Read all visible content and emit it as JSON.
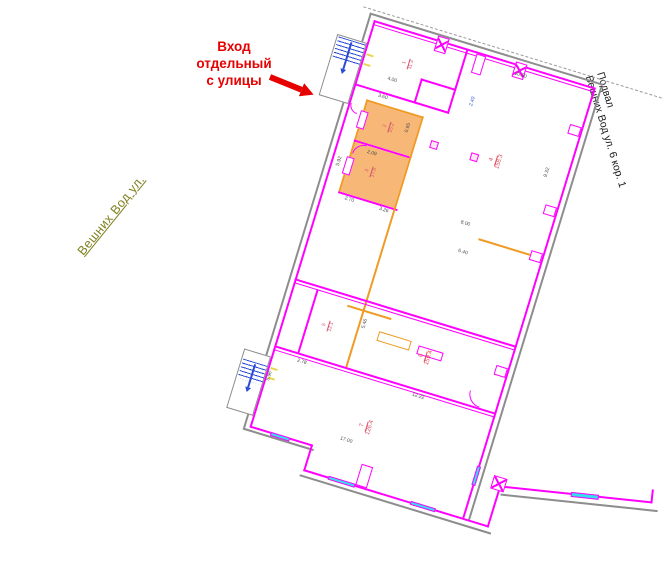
{
  "annotations": {
    "entrance_note": {
      "lines": [
        "Вход",
        "отдельный",
        "с улицы"
      ],
      "color": "#e60000"
    },
    "street_label": {
      "text": "Вешних Вод ул.",
      "color": "#7f7f1e"
    },
    "building_label": {
      "lines": [
        "Подвал",
        "Вешних Вод ул. 6 кор. 1"
      ],
      "color": "#1a1a1a"
    }
  },
  "plan": {
    "rotation_deg": 17,
    "colors": {
      "wall": "#ff00ff",
      "orange": "#ef9b26",
      "room_fill": "#f6b26b",
      "gray": "#8d8d8d",
      "dash": "#9a9a9a",
      "window": "#35e0ee",
      "stair": "#2a4bd7",
      "tick": "#e5d84b",
      "dim_text": "#4a4a4a",
      "elev": "#3b5bd0",
      "room_label": "#d4526e",
      "room_label_big": "#e04a5a",
      "column_fill": "#fde8f5"
    },
    "walls": [
      {
        "x": -14,
        "y": -10,
        "w": 312,
        "h": 0,
        "c": "dash"
      },
      {
        "x": -6,
        "y": -6,
        "w": 2,
        "h": 434,
        "c": "gray"
      },
      {
        "x": -6,
        "y": -6,
        "w": 244,
        "h": 2,
        "c": "gray"
      },
      {
        "x": 236,
        "y": -2,
        "w": 2,
        "h": 452,
        "c": "gray"
      },
      {
        "x": -6,
        "y": 428,
        "w": 74,
        "h": 2,
        "c": "gray"
      },
      {
        "x": 62,
        "y": 456,
        "w": 200,
        "h": 2,
        "c": "gray"
      },
      {
        "x": 0,
        "y": 0,
        "w": 232,
        "h": 2,
        "c": "wall"
      },
      {
        "x": 0,
        "y": 4,
        "w": 232,
        "h": 1,
        "c": "wall"
      },
      {
        "x": 0,
        "y": 0,
        "w": 2,
        "h": 426,
        "c": "wall"
      },
      {
        "x": 230,
        "y": 0,
        "w": 2,
        "h": 450,
        "c": "wall"
      },
      {
        "x": 0,
        "y": 424,
        "w": 66,
        "h": 2,
        "c": "wall"
      },
      {
        "x": 64,
        "y": 424,
        "w": 2,
        "h": 28,
        "c": "wall"
      },
      {
        "x": 64,
        "y": 450,
        "w": 194,
        "h": 2,
        "c": "wall"
      },
      {
        "x": 256,
        "y": 408,
        "w": 2,
        "h": 44,
        "c": "wall"
      },
      {
        "x": 97,
        "y": 0,
        "w": 2,
        "h": 68,
        "c": "wall"
      },
      {
        "x": 0,
        "y": 66,
        "w": 99,
        "h": 2,
        "c": "wall"
      },
      {
        "x": 62,
        "y": 42,
        "w": 37,
        "h": 1.5,
        "c": "wall"
      },
      {
        "x": 62,
        "y": 42,
        "w": 1.5,
        "h": 26,
        "c": "wall"
      },
      {
        "x": 16,
        "y": 78,
        "w": 60,
        "h": 1.5,
        "c": "orange"
      },
      {
        "x": 16,
        "y": 78,
        "w": 1.5,
        "h": 96,
        "c": "orange"
      },
      {
        "x": 16,
        "y": 120,
        "w": 60,
        "h": 1.5,
        "c": "wall"
      },
      {
        "x": 16,
        "y": 174,
        "w": 62,
        "h": 1.5,
        "c": "wall"
      },
      {
        "x": 74,
        "y": 78,
        "w": 1.5,
        "h": 262,
        "c": "orange"
      },
      {
        "x": 0,
        "y": 270,
        "w": 232,
        "h": 2,
        "c": "wall"
      },
      {
        "x": 0,
        "y": 274,
        "w": 232,
        "h": 1,
        "c": "wall"
      },
      {
        "x": 0,
        "y": 340,
        "w": 232,
        "h": 2,
        "c": "wall"
      },
      {
        "x": 0,
        "y": 344,
        "w": 232,
        "h": 1,
        "c": "wall"
      },
      {
        "x": 24,
        "y": 274,
        "w": 1.5,
        "h": 66,
        "c": "wall"
      },
      {
        "x": 58,
        "y": 280,
        "w": 46,
        "h": 2,
        "c": "orange"
      },
      {
        "x": 164,
        "y": 178,
        "w": 66,
        "h": 1.5,
        "c": "orange"
      },
      {
        "x": 138,
        "y": 298,
        "w": 26,
        "h": 9,
        "c": "wallbox"
      },
      {
        "x": 96,
        "y": 296,
        "w": 34,
        "h": 10,
        "c": "orangebox"
      },
      {
        "x": 118,
        "y": 428,
        "w": 12,
        "h": 22,
        "c": "wallbox"
      }
    ],
    "wing": {
      "x": 258,
      "y": 408,
      "rot": -11,
      "parts": [
        {
          "x": 0,
          "y": 0,
          "w": 152,
          "h": 2,
          "c": "wall"
        },
        {
          "x": 0,
          "y": 8,
          "w": 158,
          "h": 2,
          "c": "gray"
        },
        {
          "x": 150,
          "y": -12,
          "w": 2,
          "h": 14,
          "c": "wall"
        }
      ],
      "window": {
        "x": 70,
        "y": -1,
        "w": 28,
        "h": 5
      }
    },
    "fills": [
      {
        "x": 18,
        "y": 80,
        "w": 56,
        "h": 40
      },
      {
        "x": 18,
        "y": 122,
        "w": 56,
        "h": 52
      }
    ],
    "windows": [
      {
        "x": 15,
        "y": 92,
        "w": 4,
        "h": 14
      },
      {
        "x": 15,
        "y": 140,
        "w": 4,
        "h": 14
      },
      {
        "x": 22,
        "y": 424,
        "w": 20,
        "h": 4
      },
      {
        "x": 90,
        "y": 449,
        "w": 28,
        "h": 4
      },
      {
        "x": 176,
        "y": 449,
        "w": 26,
        "h": 4
      },
      {
        "x": 229,
        "y": 396,
        "w": 4,
        "h": 20
      }
    ],
    "columns": [
      {
        "t": "x",
        "x": 66,
        "y": -4,
        "w": 12,
        "h": 16
      },
      {
        "t": "x",
        "x": 148,
        "y": -2,
        "w": 12,
        "h": 16
      },
      {
        "t": "x",
        "x": 248,
        "y": 400,
        "w": 14,
        "h": 14
      },
      {
        "t": "pil",
        "x": 108,
        "y": 2,
        "w": 10,
        "h": 20
      },
      {
        "t": "pil",
        "x": 218,
        "y": 42,
        "w": 12,
        "h": 10
      },
      {
        "t": "pil",
        "x": 218,
        "y": 126,
        "w": 12,
        "h": 10
      },
      {
        "t": "pil",
        "x": 218,
        "y": 174,
        "w": 12,
        "h": 10
      },
      {
        "t": "pil",
        "x": 218,
        "y": 294,
        "w": 12,
        "h": 10
      },
      {
        "t": "pil",
        "x": 14,
        "y": 90,
        "w": 8,
        "h": 18
      },
      {
        "t": "pil",
        "x": 14,
        "y": 138,
        "w": 8,
        "h": 18
      },
      {
        "t": "sq",
        "x": 90,
        "y": 98,
        "w": 8,
        "h": 8
      },
      {
        "t": "sq",
        "x": 132,
        "y": 98,
        "w": 8,
        "h": 8
      }
    ],
    "stairs": [
      {
        "x": -31,
        "y": 24,
        "w": 31,
        "h": 64,
        "tx": -29,
        "ty": 26,
        "tw": 28,
        "th": 22,
        "ax": -16,
        "ay": 28,
        "al": 28
      },
      {
        "x": -28,
        "y": 352,
        "w": 28,
        "h": 62,
        "tx": -26,
        "ty": 362,
        "tw": 25,
        "th": 20,
        "ax": -14,
        "ay": 364,
        "al": 24
      }
    ],
    "arcs": [
      {
        "x": 18,
        "y": 122,
        "r": 12,
        "q": "tl"
      },
      {
        "x": 200,
        "y": 326,
        "r": 14,
        "q": "bl"
      },
      {
        "x": 2,
        "y": 86,
        "r": 9,
        "q": "bl"
      }
    ],
    "ticks": [
      {
        "x": 3,
        "y": 34
      },
      {
        "x": 3,
        "y": 44
      },
      {
        "x": 3,
        "y": 362
      },
      {
        "x": 3,
        "y": 372
      }
    ],
    "dimensions": [
      {
        "t": "4.00",
        "x": 30,
        "y": 50,
        "r": 0
      },
      {
        "t": "3.60",
        "x": 26,
        "y": 69,
        "r": 0
      },
      {
        "t": "0.65",
        "x": 62,
        "y": 98,
        "r": 90
      },
      {
        "t": "2.09",
        "x": 32,
        "y": 126,
        "r": 0
      },
      {
        "t": "5.92",
        "x": 6,
        "y": 150,
        "r": 90
      },
      {
        "t": "10.50",
        "x": 150,
        "y": 8,
        "r": 0
      },
      {
        "t": "9.32",
        "x": 208,
        "y": 100,
        "r": 90
      },
      {
        "t": "2.40",
        "x": 116,
        "y": 54,
        "r": 90,
        "c": "elev"
      },
      {
        "t": "2.70",
        "x": 24,
        "y": 177,
        "r": 0
      },
      {
        "t": "3.26",
        "x": 60,
        "y": 177,
        "r": 0
      },
      {
        "t": "8.00",
        "x": 142,
        "y": 166,
        "r": 0
      },
      {
        "t": "6.40",
        "x": 148,
        "y": 194,
        "r": 0
      },
      {
        "t": "5.46",
        "x": 78,
        "y": 298,
        "r": 90
      },
      {
        "t": "2.78",
        "x": 26,
        "y": 346,
        "r": 0
      },
      {
        "t": "12.22",
        "x": 146,
        "y": 345,
        "r": 0
      },
      {
        "t": "17.00",
        "x": 90,
        "y": 408,
        "r": 0
      },
      {
        "t": "5.96",
        "x": 2,
        "y": 376,
        "r": 90
      }
    ],
    "room_labels": [
      {
        "num": "1",
        "area": "11.3",
        "x": 40,
        "y": 26,
        "big": false
      },
      {
        "num": "2",
        "area": "15.2",
        "x": 40,
        "y": 92,
        "big": false
      },
      {
        "num": "3",
        "area": "17.6",
        "x": 36,
        "y": 140,
        "big": false
      },
      {
        "num": "4",
        "area": "158.3",
        "x": 150,
        "y": 92,
        "big": true
      },
      {
        "num": "5",
        "area": "12.1",
        "x": 40,
        "y": 300,
        "big": false
      },
      {
        "num": "6",
        "area": "159.4",
        "x": 140,
        "y": 300,
        "big": true
      },
      {
        "num": "7",
        "area": "126.4",
        "x": 104,
        "y": 384,
        "big": true
      }
    ]
  }
}
